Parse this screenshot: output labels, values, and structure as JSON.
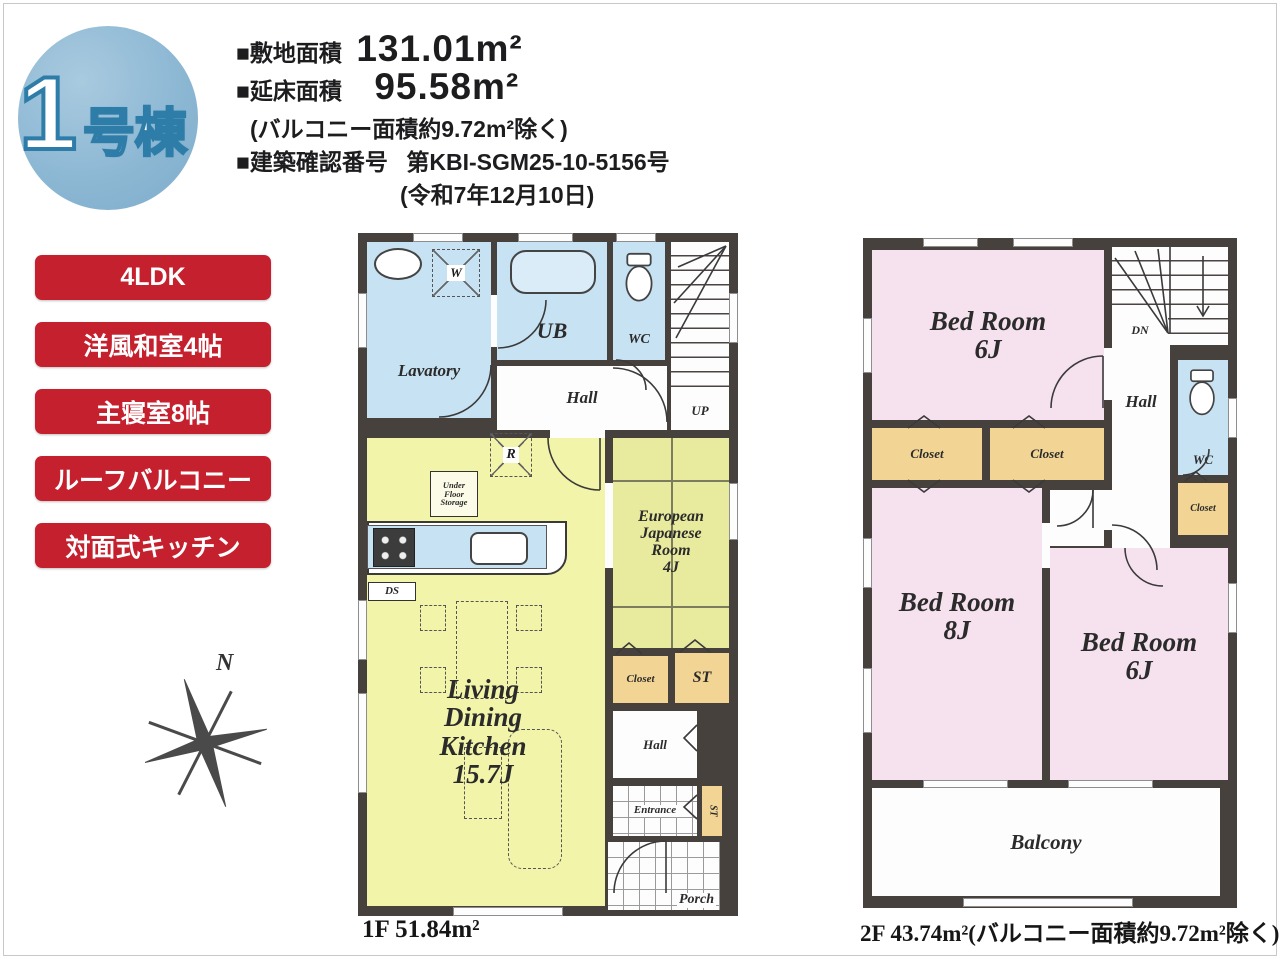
{
  "badge": {
    "number": "1",
    "suffix": "号棟"
  },
  "header": {
    "site_area_label": "■敷地面積",
    "site_area_value": "131.01m²",
    "floor_area_label": "■延床面積",
    "floor_area_value": "95.58m²",
    "balcony_note": "(バルコニー面積約9.72m²除く)",
    "confirmation_label": "■建築確認番号",
    "confirmation_value": "第KBI-SGM25-10-5156号",
    "confirmation_date": "(令和7年12月10日)"
  },
  "features": [
    {
      "label": "4LDK"
    },
    {
      "label": "洋風和室4帖"
    },
    {
      "label": "主寝室8帖"
    },
    {
      "label": "ルーフバルコニー"
    },
    {
      "label": "対面式キッチン"
    }
  ],
  "compass": {
    "north_label": "N"
  },
  "floor1": {
    "area_label": "1F 51.84m²",
    "labels": {
      "lavatory": "Lavatory",
      "washer": "W",
      "ub": "UB",
      "wc": "WC",
      "up": "UP",
      "hall": "Hall",
      "fridge": "R",
      "ufs1": "Under",
      "ufs2": "Floor",
      "ufs3": "Storage",
      "ds": "DS",
      "ldk1": "Living",
      "ldk2": "Dining",
      "ldk3": "Kitchen",
      "ldk4": "15.7J",
      "ej1": "European",
      "ej2": "Japanese",
      "ej3": "Room",
      "ej4": "4J",
      "closet": "Closet",
      "st": "ST",
      "hall2": "Hall",
      "entrance": "Entrance",
      "st2": "ST",
      "porch": "Porch"
    }
  },
  "floor2": {
    "area_label": "2F 43.74m²(バルコニー面積約9.72m²除く)",
    "labels": {
      "bedroom_a_name": "Bed Room",
      "bedroom_a_size": "6J",
      "bedroom_b_name": "Bed Room",
      "bedroom_b_size": "8J",
      "bedroom_c_name": "Bed Room",
      "bedroom_c_size": "6J",
      "dn": "DN",
      "hall": "Hall",
      "wc": "WC",
      "closet": "Closet",
      "balcony": "Balcony"
    }
  },
  "colors": {
    "accent_red": "#c5202e",
    "badge_blue": "#8db8d4",
    "wall": "#47413e",
    "room_blue": "#c7e2f2",
    "room_yellow": "#f2f4a9",
    "room_tatami": "#e8eb9e",
    "room_pink": "#f6e2ee",
    "room_tan": "#f2d494"
  }
}
